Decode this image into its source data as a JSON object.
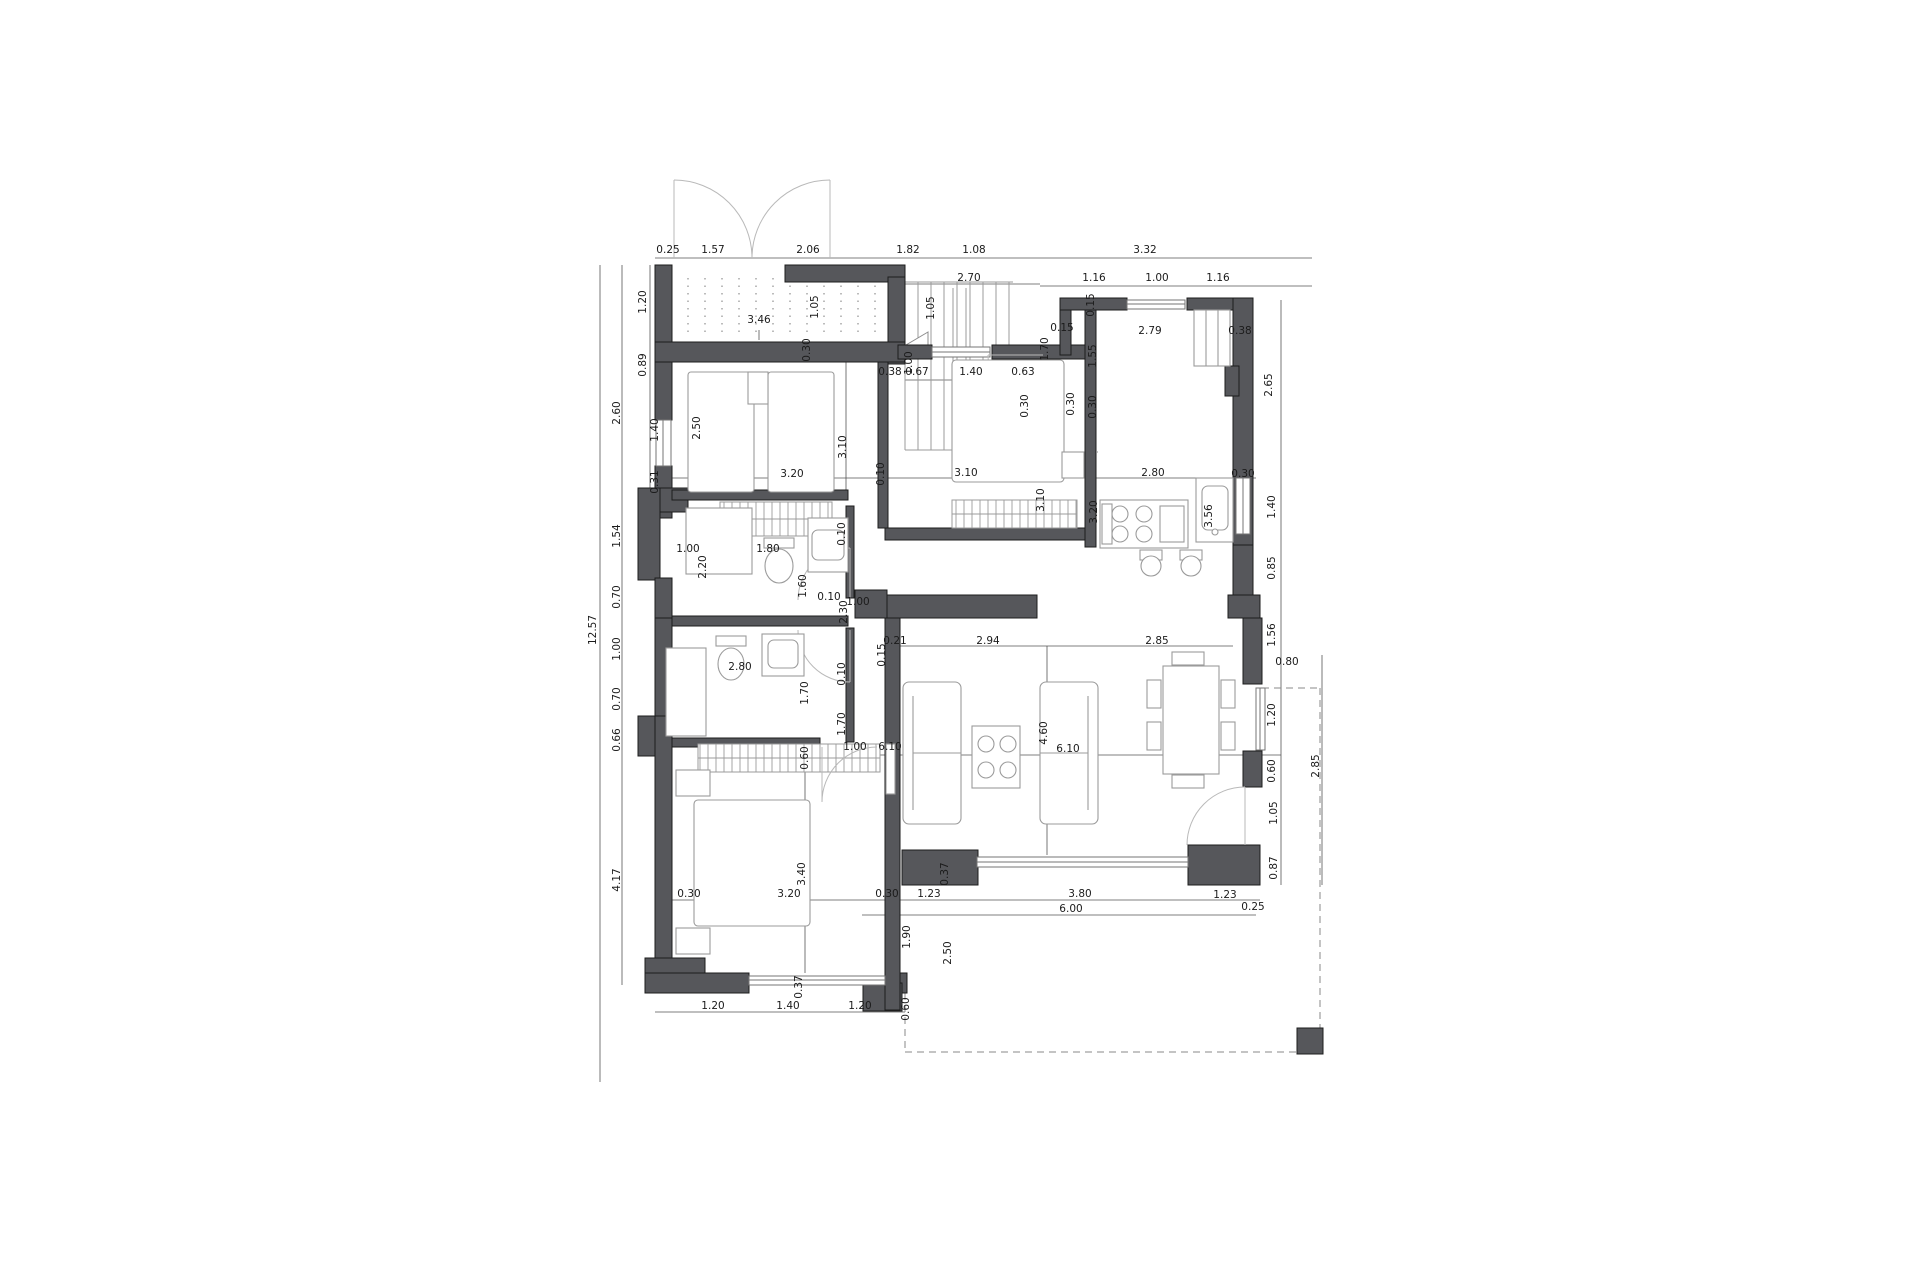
{
  "plan": {
    "type": "architectural-floor-plan",
    "colors": {
      "background": "#ffffff",
      "wall_fill": "#56575b",
      "wall_edge": "#1c1c1c",
      "furniture_line": "#9b9b9b",
      "dimension_line": "#555555",
      "dimension_text": "#1b1b1b",
      "dashed_line": "#8a8a8a"
    },
    "dim_labels": [
      {
        "t": "0.25",
        "x": 668,
        "y": 253,
        "r": 0
      },
      {
        "t": "1.57",
        "x": 713,
        "y": 253,
        "r": 0
      },
      {
        "t": "2.06",
        "x": 808,
        "y": 253,
        "r": 0
      },
      {
        "t": "1.82",
        "x": 908,
        "y": 253,
        "r": 0
      },
      {
        "t": "1.08",
        "x": 974,
        "y": 253,
        "r": 0
      },
      {
        "t": "3.32",
        "x": 1145,
        "y": 253,
        "r": 0
      },
      {
        "t": "2.70",
        "x": 969,
        "y": 281,
        "r": 0
      },
      {
        "t": "1.16",
        "x": 1094,
        "y": 281,
        "r": 0
      },
      {
        "t": "1.00",
        "x": 1157,
        "y": 281,
        "r": 0
      },
      {
        "t": "1.16",
        "x": 1218,
        "y": 281,
        "r": 0
      },
      {
        "t": "12.57",
        "x": 596,
        "y": 630,
        "r": 1
      },
      {
        "t": "1.20",
        "x": 646,
        "y": 302,
        "r": 1
      },
      {
        "t": "0.89",
        "x": 646,
        "y": 365,
        "r": 1
      },
      {
        "t": "2.60",
        "x": 620,
        "y": 413,
        "r": 1
      },
      {
        "t": "1.40",
        "x": 658,
        "y": 430,
        "r": 1
      },
      {
        "t": "0.31",
        "x": 658,
        "y": 482,
        "r": 1
      },
      {
        "t": "1.54",
        "x": 620,
        "y": 536,
        "r": 1
      },
      {
        "t": "0.70",
        "x": 620,
        "y": 597,
        "r": 1
      },
      {
        "t": "1.00",
        "x": 620,
        "y": 649,
        "r": 1
      },
      {
        "t": "0.70",
        "x": 620,
        "y": 699,
        "r": 1
      },
      {
        "t": "0.66",
        "x": 620,
        "y": 740,
        "r": 1
      },
      {
        "t": "4.17",
        "x": 620,
        "y": 880,
        "r": 1
      },
      {
        "t": "3.46",
        "x": 759,
        "y": 323,
        "r": 0
      },
      {
        "t": "1.05",
        "x": 818,
        "y": 307,
        "r": 1
      },
      {
        "t": "0.30",
        "x": 810,
        "y": 350,
        "r": 1
      },
      {
        "t": "1.05",
        "x": 934,
        "y": 308,
        "r": 1
      },
      {
        "t": "1.00",
        "x": 912,
        "y": 363,
        "r": 1
      },
      {
        "t": "0.38",
        "x": 890,
        "y": 375,
        "r": 0
      },
      {
        "t": "0.67",
        "x": 917,
        "y": 375,
        "r": 0
      },
      {
        "t": "1.40",
        "x": 971,
        "y": 375,
        "r": 0
      },
      {
        "t": "0.63",
        "x": 1023,
        "y": 375,
        "r": 0
      },
      {
        "t": "0.30",
        "x": 1028,
        "y": 406,
        "r": 1
      },
      {
        "t": "0.30",
        "x": 1074,
        "y": 404,
        "r": 1
      },
      {
        "t": "1.70",
        "x": 1048,
        "y": 349,
        "r": 1
      },
      {
        "t": "1.55",
        "x": 1096,
        "y": 356,
        "r": 1
      },
      {
        "t": "0.15",
        "x": 1062,
        "y": 331,
        "r": 0
      },
      {
        "t": "0.15",
        "x": 1094,
        "y": 305,
        "r": 1
      },
      {
        "t": "2.50",
        "x": 700,
        "y": 428,
        "r": 1
      },
      {
        "t": "3.10",
        "x": 846,
        "y": 447,
        "r": 1
      },
      {
        "t": "3.20",
        "x": 792,
        "y": 477,
        "r": 0
      },
      {
        "t": "0.10",
        "x": 884,
        "y": 474,
        "r": 1
      },
      {
        "t": "3.10",
        "x": 966,
        "y": 476,
        "r": 0
      },
      {
        "t": "3.10",
        "x": 1044,
        "y": 500,
        "r": 1
      },
      {
        "t": "3.20",
        "x": 1097,
        "y": 512,
        "r": 1
      },
      {
        "t": "0.30",
        "x": 1096,
        "y": 407,
        "r": 1
      },
      {
        "t": "2.79",
        "x": 1150,
        "y": 334,
        "r": 0
      },
      {
        "t": "0.38",
        "x": 1240,
        "y": 334,
        "r": 0
      },
      {
        "t": "2.65",
        "x": 1272,
        "y": 385,
        "r": 1
      },
      {
        "t": "2.80",
        "x": 1153,
        "y": 476,
        "r": 0
      },
      {
        "t": "0.30",
        "x": 1243,
        "y": 477,
        "r": 0
      },
      {
        "t": "3.56",
        "x": 1212,
        "y": 516,
        "r": 1
      },
      {
        "t": "1.40",
        "x": 1275,
        "y": 507,
        "r": 1
      },
      {
        "t": "0.85",
        "x": 1275,
        "y": 568,
        "r": 1
      },
      {
        "t": "1.56",
        "x": 1275,
        "y": 635,
        "r": 1
      },
      {
        "t": "1.00",
        "x": 688,
        "y": 552,
        "r": 0
      },
      {
        "t": "1.80",
        "x": 768,
        "y": 552,
        "r": 0
      },
      {
        "t": "2.20",
        "x": 706,
        "y": 567,
        "r": 1
      },
      {
        "t": "1.60",
        "x": 806,
        "y": 586,
        "r": 1
      },
      {
        "t": "0.10",
        "x": 845,
        "y": 534,
        "r": 1
      },
      {
        "t": "0.10",
        "x": 829,
        "y": 600,
        "r": 0
      },
      {
        "t": "1.00",
        "x": 858,
        "y": 605,
        "r": 0
      },
      {
        "t": "2.30",
        "x": 847,
        "y": 612,
        "r": 1
      },
      {
        "t": "2.80",
        "x": 740,
        "y": 670,
        "r": 0
      },
      {
        "t": "0.10",
        "x": 845,
        "y": 674,
        "r": 1
      },
      {
        "t": "1.70",
        "x": 808,
        "y": 693,
        "r": 1
      },
      {
        "t": "1.70",
        "x": 845,
        "y": 724,
        "r": 1
      },
      {
        "t": "0.60",
        "x": 808,
        "y": 758,
        "r": 1
      },
      {
        "t": "0.21",
        "x": 895,
        "y": 644,
        "r": 0
      },
      {
        "t": "2.94",
        "x": 988,
        "y": 644,
        "r": 0
      },
      {
        "t": "2.85",
        "x": 1157,
        "y": 644,
        "r": 0
      },
      {
        "t": "0.15",
        "x": 885,
        "y": 655,
        "r": 1
      },
      {
        "t": "1.00",
        "x": 855,
        "y": 750,
        "r": 0
      },
      {
        "t": "6.10",
        "x": 890,
        "y": 750,
        "r": 0
      },
      {
        "t": "6.10",
        "x": 1068,
        "y": 752,
        "r": 0
      },
      {
        "t": "4.60",
        "x": 1047,
        "y": 733,
        "r": 1
      },
      {
        "t": "0.80",
        "x": 1287,
        "y": 665,
        "r": 0
      },
      {
        "t": "1.20",
        "x": 1275,
        "y": 715,
        "r": 1
      },
      {
        "t": "0.60",
        "x": 1275,
        "y": 771,
        "r": 1
      },
      {
        "t": "1.05",
        "x": 1277,
        "y": 813,
        "r": 1
      },
      {
        "t": "0.87",
        "x": 1277,
        "y": 868,
        "r": 1
      },
      {
        "t": "2.85",
        "x": 1319,
        "y": 766,
        "r": 1
      },
      {
        "t": "0.30",
        "x": 689,
        "y": 897,
        "r": 0
      },
      {
        "t": "3.20",
        "x": 789,
        "y": 897,
        "r": 0
      },
      {
        "t": "3.40",
        "x": 805,
        "y": 874,
        "r": 1
      },
      {
        "t": "0.30",
        "x": 887,
        "y": 897,
        "r": 0
      },
      {
        "t": "1.23",
        "x": 929,
        "y": 897,
        "r": 0
      },
      {
        "t": "3.80",
        "x": 1080,
        "y": 897,
        "r": 0
      },
      {
        "t": "1.23",
        "x": 1225,
        "y": 898,
        "r": 0
      },
      {
        "t": "6.00",
        "x": 1071,
        "y": 912,
        "r": 0
      },
      {
        "t": "0.25",
        "x": 1253,
        "y": 910,
        "r": 0
      },
      {
        "t": "0.37",
        "x": 948,
        "y": 874,
        "r": 1
      },
      {
        "t": "1.90",
        "x": 910,
        "y": 937,
        "r": 1
      },
      {
        "t": "2.50",
        "x": 951,
        "y": 953,
        "r": 1
      },
      {
        "t": "0.37",
        "x": 802,
        "y": 987,
        "r": 1
      },
      {
        "t": "1.20",
        "x": 713,
        "y": 1009,
        "r": 0
      },
      {
        "t": "1.40",
        "x": 788,
        "y": 1009,
        "r": 0
      },
      {
        "t": "1.20",
        "x": 860,
        "y": 1009,
        "r": 0
      },
      {
        "t": "0.60",
        "x": 909,
        "y": 1009,
        "r": 1
      }
    ]
  }
}
